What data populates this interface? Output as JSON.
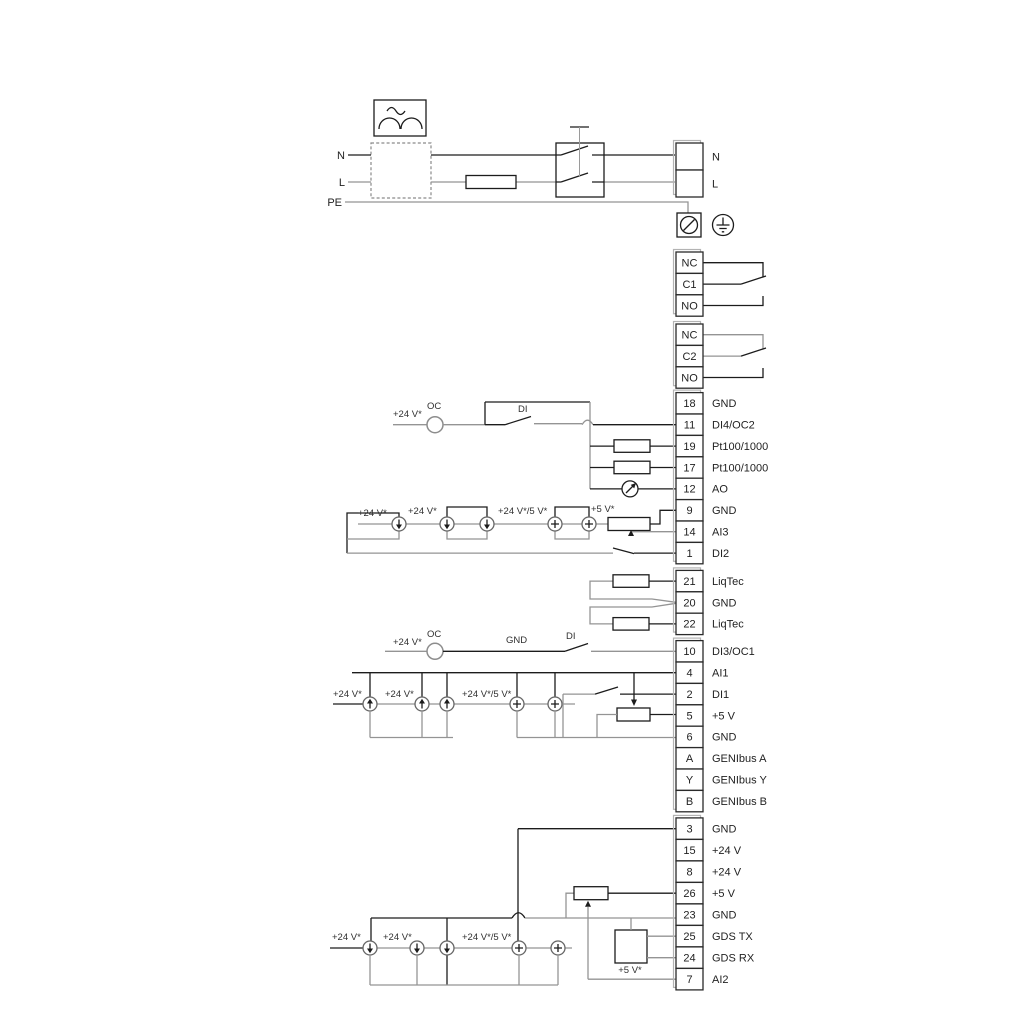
{
  "power": {
    "n_left": "N",
    "l_left": "L",
    "pe": "PE"
  },
  "groups": [
    {
      "name": "mains-terminals",
      "rows": [
        {
          "id": "",
          "label": "N"
        },
        {
          "id": "",
          "label": "L"
        }
      ]
    },
    {
      "name": "relay-1",
      "rows": [
        {
          "id": "NC",
          "label": ""
        },
        {
          "id": "C1",
          "label": ""
        },
        {
          "id": "NO",
          "label": ""
        }
      ]
    },
    {
      "name": "relay-2",
      "rows": [
        {
          "id": "NC",
          "label": ""
        },
        {
          "id": "C2",
          "label": ""
        },
        {
          "id": "NO",
          "label": ""
        }
      ]
    },
    {
      "name": "io-block-1",
      "rows": [
        {
          "id": "18",
          "label": "GND"
        },
        {
          "id": "11",
          "label": "DI4/OC2"
        },
        {
          "id": "19",
          "label": "Pt100/1000"
        },
        {
          "id": "17",
          "label": "Pt100/1000"
        },
        {
          "id": "12",
          "label": "AO"
        },
        {
          "id": "9",
          "label": "GND"
        },
        {
          "id": "14",
          "label": "AI3"
        },
        {
          "id": "1",
          "label": "DI2"
        }
      ]
    },
    {
      "name": "liqtec-block",
      "rows": [
        {
          "id": "21",
          "label": "LiqTec"
        },
        {
          "id": "20",
          "label": "GND"
        },
        {
          "id": "22",
          "label": "LiqTec"
        }
      ]
    },
    {
      "name": "io-block-2",
      "rows": [
        {
          "id": "10",
          "label": "DI3/OC1"
        },
        {
          "id": "4",
          "label": "AI1"
        },
        {
          "id": "2",
          "label": "DI1"
        },
        {
          "id": "5",
          "label": "+5 V"
        },
        {
          "id": "6",
          "label": "GND"
        },
        {
          "id": "A",
          "label": "GENIbus A"
        },
        {
          "id": "Y",
          "label": "GENIbus Y"
        },
        {
          "id": "B",
          "label": "GENIbus B"
        }
      ]
    },
    {
      "name": "io-block-3",
      "rows": [
        {
          "id": "3",
          "label": "GND"
        },
        {
          "id": "15",
          "label": "+24 V"
        },
        {
          "id": "8",
          "label": "+24 V"
        },
        {
          "id": "26",
          "label": "+5 V"
        },
        {
          "id": "23",
          "label": "GND"
        },
        {
          "id": "25",
          "label": "GDS TX"
        },
        {
          "id": "24",
          "label": "GDS RX"
        },
        {
          "id": "7",
          "label": "AI2"
        }
      ]
    }
  ],
  "annotations": {
    "g1_v24": "+24 V*",
    "g1_oc": "OC",
    "g1_di": "DI",
    "gA_v24a": "+24 V*",
    "gA_v24b": "+24 V*",
    "gA_v245": "+24 V*/5 V*",
    "gA_v5": "+5 V*",
    "g10_v24": "+24 V*",
    "g10_oc": "OC",
    "g10_gnd": "GND",
    "g10_di": "DI",
    "gB_v24a": "+24 V*",
    "gB_v24b": "+24 V*",
    "gB_v245": "+24 V*/5 V*",
    "gC_v24a": "+24 V*",
    "gC_v24b": "+24 V*",
    "gC_v245": "+24 V*/5 V*",
    "gC_v5": "+5 V*"
  }
}
